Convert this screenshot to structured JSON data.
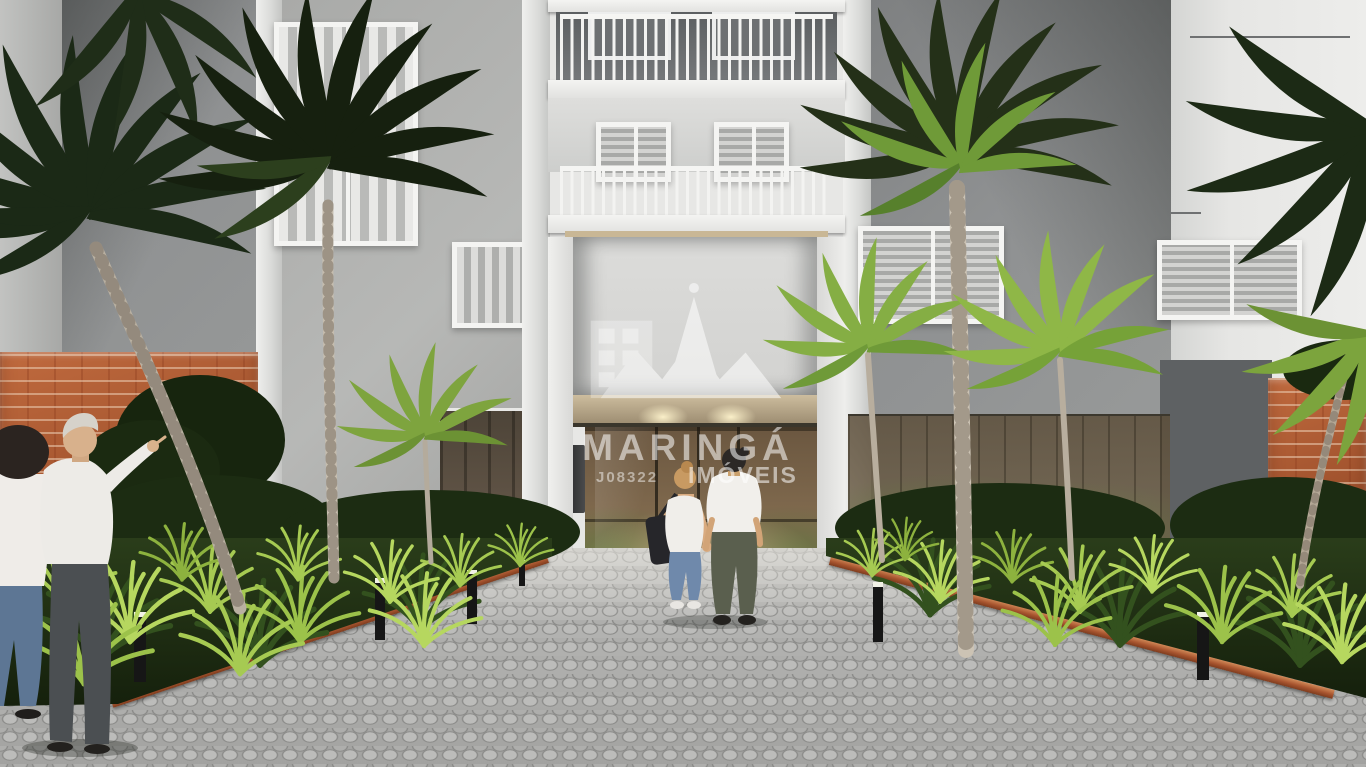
{
  "scene": {
    "kind": "3d-architectural-rendering",
    "subject": "residential building entrance with palm trees, landscaped beds and paver walkway"
  },
  "watermark": {
    "brand": "MARINGÁ",
    "subtitle": "IMÓVEIS",
    "registration": "J08322",
    "logo_icon": "building-spire-mountains-icon",
    "text_color": "#ffffff"
  },
  "palette": {
    "facade_light": "#e7e7e5",
    "facade_gray": "#8f9192",
    "brick": "#ad5a33",
    "palm_dark": "#1c2a15",
    "palm_bright": "#85ae44",
    "grass_bright": "#a6ca52",
    "soffit_beige": "#c0ae8c",
    "entry_glass": "#7d674c",
    "pavement": "#b0b0ae",
    "sky": "#c2d9e9"
  }
}
